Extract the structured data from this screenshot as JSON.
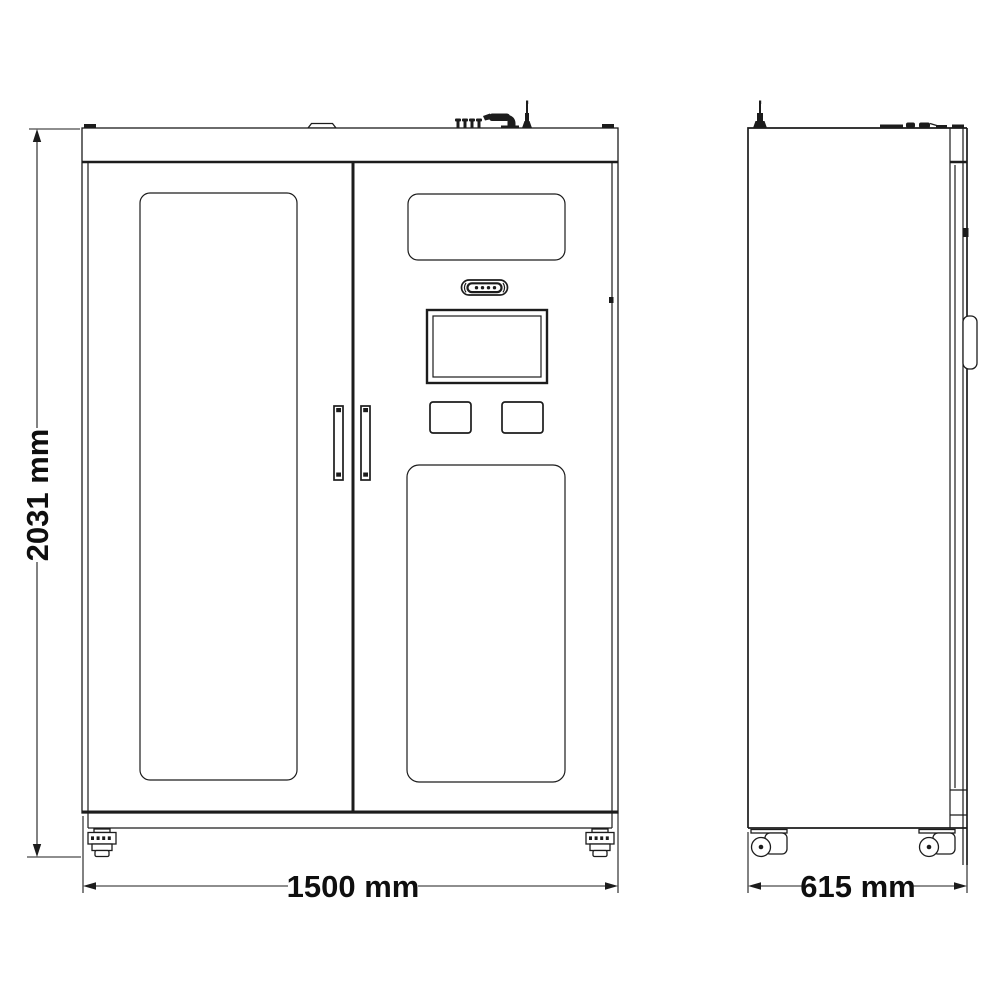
{
  "meta": {
    "background": "#ffffff",
    "line_color": "#1c1c1c",
    "text_color": "#0f0f0f"
  },
  "dimensions": {
    "height_label": "2031 mm",
    "width_label": "1500 mm",
    "depth_label": "615 mm"
  }
}
